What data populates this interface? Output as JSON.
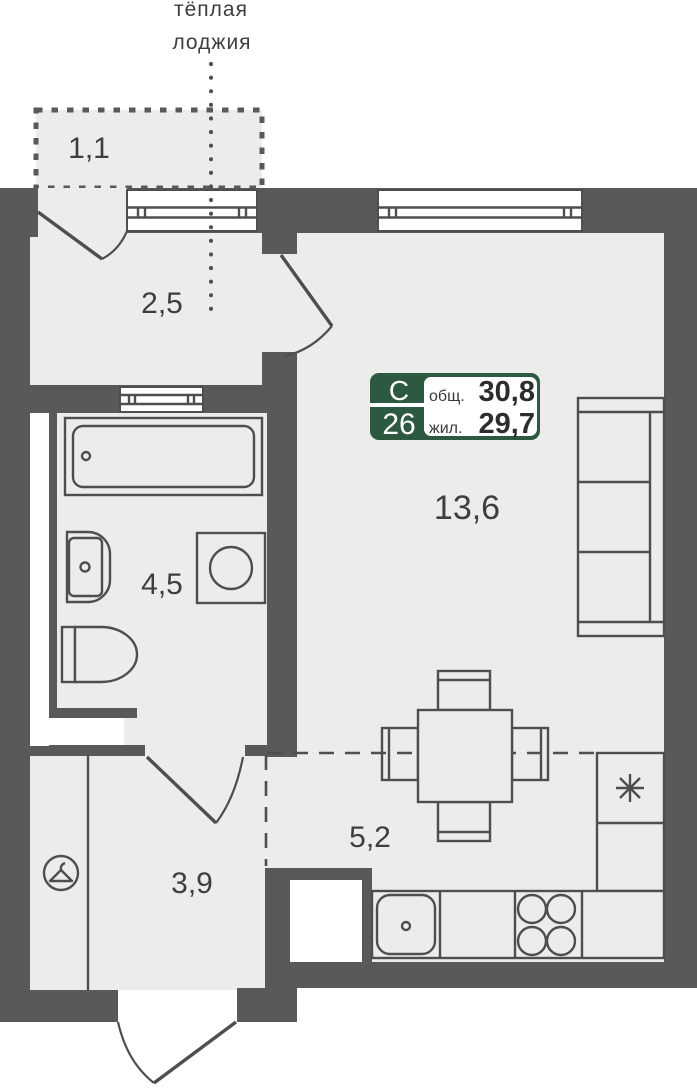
{
  "loggia_note": {
    "line1": "тёплая",
    "line2": "лоджия"
  },
  "rooms": {
    "balcony_area": "1,1",
    "loggia_area": "2,5",
    "bathroom_area": "4,5",
    "living_room_area": "13,6",
    "kitchen_area": "5,2",
    "hallway_area": "3,9"
  },
  "badge": {
    "plan_type": "С",
    "apartment_number": "26",
    "total_area_label": "общ.",
    "total_area_value": "30,8",
    "living_area_label": "жил.",
    "living_area_value": "29,7"
  },
  "icons": {
    "wardrobe": "hanger-icon",
    "refrigerator": "asterisk-icon",
    "stove": "four-burners-icon",
    "sink": "drain-dot-icon"
  },
  "colors": {
    "wall": "#595959",
    "floor": "#ececeb",
    "line": "#4e4e4e",
    "text": "#3e3e3e",
    "accent-green": "#2e5941",
    "white": "#ffffff"
  }
}
